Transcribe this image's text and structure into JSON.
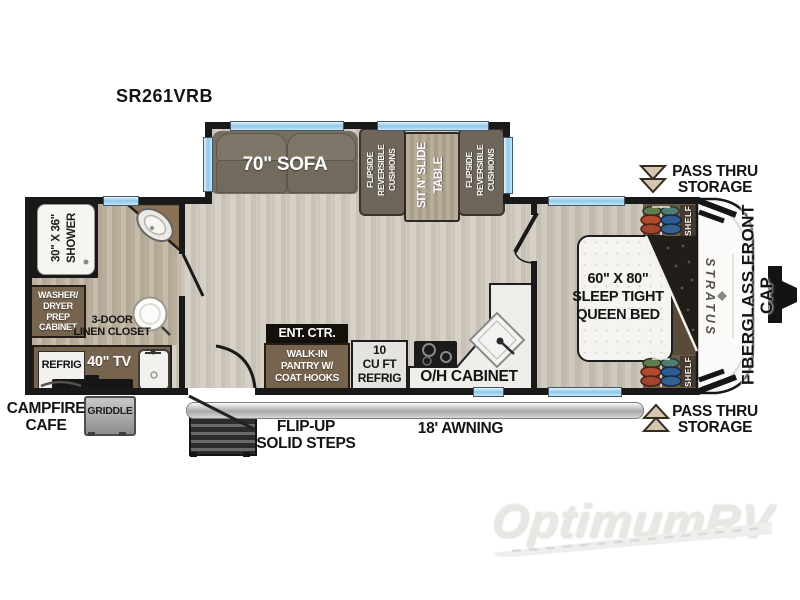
{
  "title": "SR261VRB",
  "colors": {
    "wall": "#191919",
    "window_blue": "#8ec8e8",
    "cabinet_brown": "#76644e",
    "sofa_taupe": "#766e61",
    "floor_light": "#d0cac1",
    "floor_bath": "#bfb4a3",
    "clothes_green": "#5f7d4f",
    "clothes_red": "#b2492f",
    "clothes_blue": "#2f5a94",
    "awning_gray": "#b5b5b5"
  },
  "labels": {
    "model": "SR261VRB",
    "sofa": "70\" SOFA",
    "cushions": "FLIPSIDE\nREVERSIBLE\nCUSHIONS",
    "table": "SIT N' SLIDE\nTABLE",
    "pass_thru": "PASS THRU\nSTORAGE",
    "shower": "30\" X 36\"\nSHOWER",
    "washer_dryer": "WASHER/\nDRYER\nPREP\nCABINET",
    "linen_closet": "3-DOOR\nLINEN CLOSET",
    "refrig_exterior": "REFRIG",
    "tv": "40\" TV",
    "campfire_cafe": "CAMPFIRE\nCAFE",
    "griddle": "GRIDDLE",
    "ent_ctr": "ENT. CTR.",
    "pantry": "WALK-IN\nPANTRY W/\nCOAT HOOKS",
    "refrig_main": "10\nCU FT\nREFRIG",
    "oh_cabinet": "O/H CABINET",
    "queen_bed": "60\" X 80\"\nSLEEP TIGHT\nQUEEN BED",
    "shelf": "SHELF",
    "stratus": "STRATUS",
    "fiberglass": "FIBERGLASS FRONT CAP",
    "steps": "FLIP-UP\nSOLID STEPS",
    "awning": "18' AWNING",
    "watermark": "OptimumRV"
  },
  "icons": {
    "bath_sink": "ellipse-basin",
    "toilet": "circle-bowl",
    "kitchen_sink": "diamond-basin",
    "campfire_sink": "rounded-basin",
    "cooktop": "burner-circles",
    "tv": "flat-screen-slab",
    "wardrobe_clothes": "hanging-clothes-rod",
    "pass_thru_arrow_down": "double-chevron-down",
    "pass_thru_arrow_up": "double-chevron-up",
    "hitch": "trailer-tongue",
    "door_swing": "quarter-arc",
    "watermark_road": "road-swoosh"
  }
}
